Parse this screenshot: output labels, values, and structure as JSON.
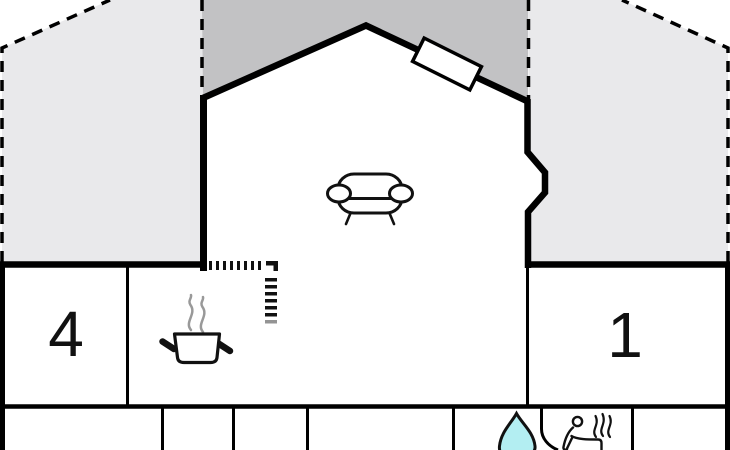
{
  "plan": {
    "type": "house-cross-section-floor-plan",
    "rooms": [
      {
        "id": "room-4",
        "label": "4"
      },
      {
        "id": "room-1",
        "label": "1"
      }
    ],
    "icons": [
      "sofa-icon",
      "roof-window-icon",
      "cooking-pot-icon",
      "pot-steam-icon",
      "water-drop-icon",
      "sauna-person-icon",
      "sauna-steam-icon"
    ],
    "colors": {
      "background": "#ffffff",
      "roof_shade_light": "#e9e9eb",
      "roof_shade_dark": "#c2c2c4",
      "line": "#000000",
      "steam_gray": "#999999",
      "water": "#b3eef2",
      "label": "#111111"
    }
  }
}
